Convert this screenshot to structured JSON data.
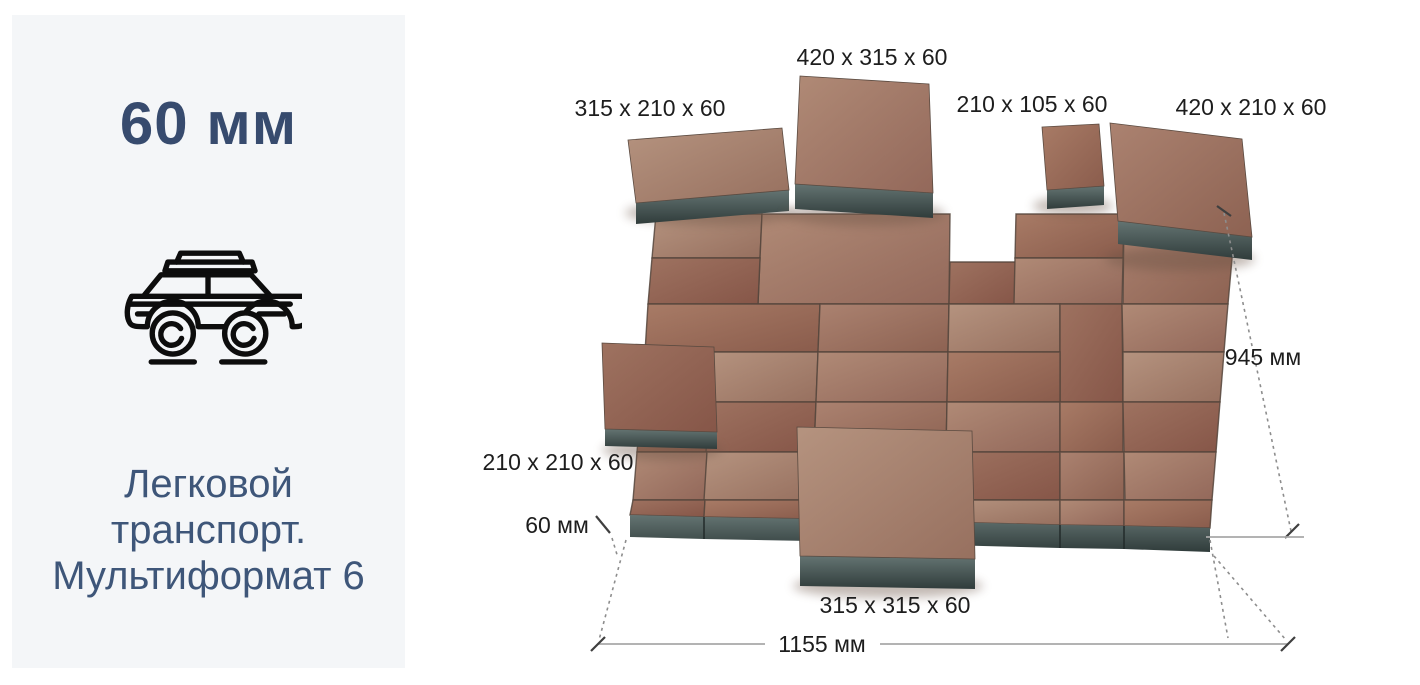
{
  "panel": {
    "thickness_label": "60 мм",
    "caption_lines": [
      "Легковой",
      "транспорт.",
      "Мультиформат 6"
    ],
    "icon": "car-icon"
  },
  "diagram": {
    "labels": {
      "s420x315": "420 x 315 x 60",
      "s315x210": "315 x 210 x 60",
      "s210x105": "210 x 105 x 60",
      "s420x210": "420 x 210 x 60",
      "s210x210": "210 x 210 x 60",
      "s315x315": "315 x 315 x 60",
      "width": "1155 мм",
      "depth": "945 мм",
      "thickness": "60 мм"
    }
  },
  "colors": {
    "panel_bg": "#f4f6f8",
    "panel_text": "#3e5679",
    "title_text": "#374b6e",
    "label_text": "#1d1d1d",
    "stone_top_light": "#b5937f",
    "stone_top_dark": "#865648",
    "stone_base_top": "#647472",
    "stone_base_bottom": "#303c3b",
    "background": "#ffffff"
  }
}
